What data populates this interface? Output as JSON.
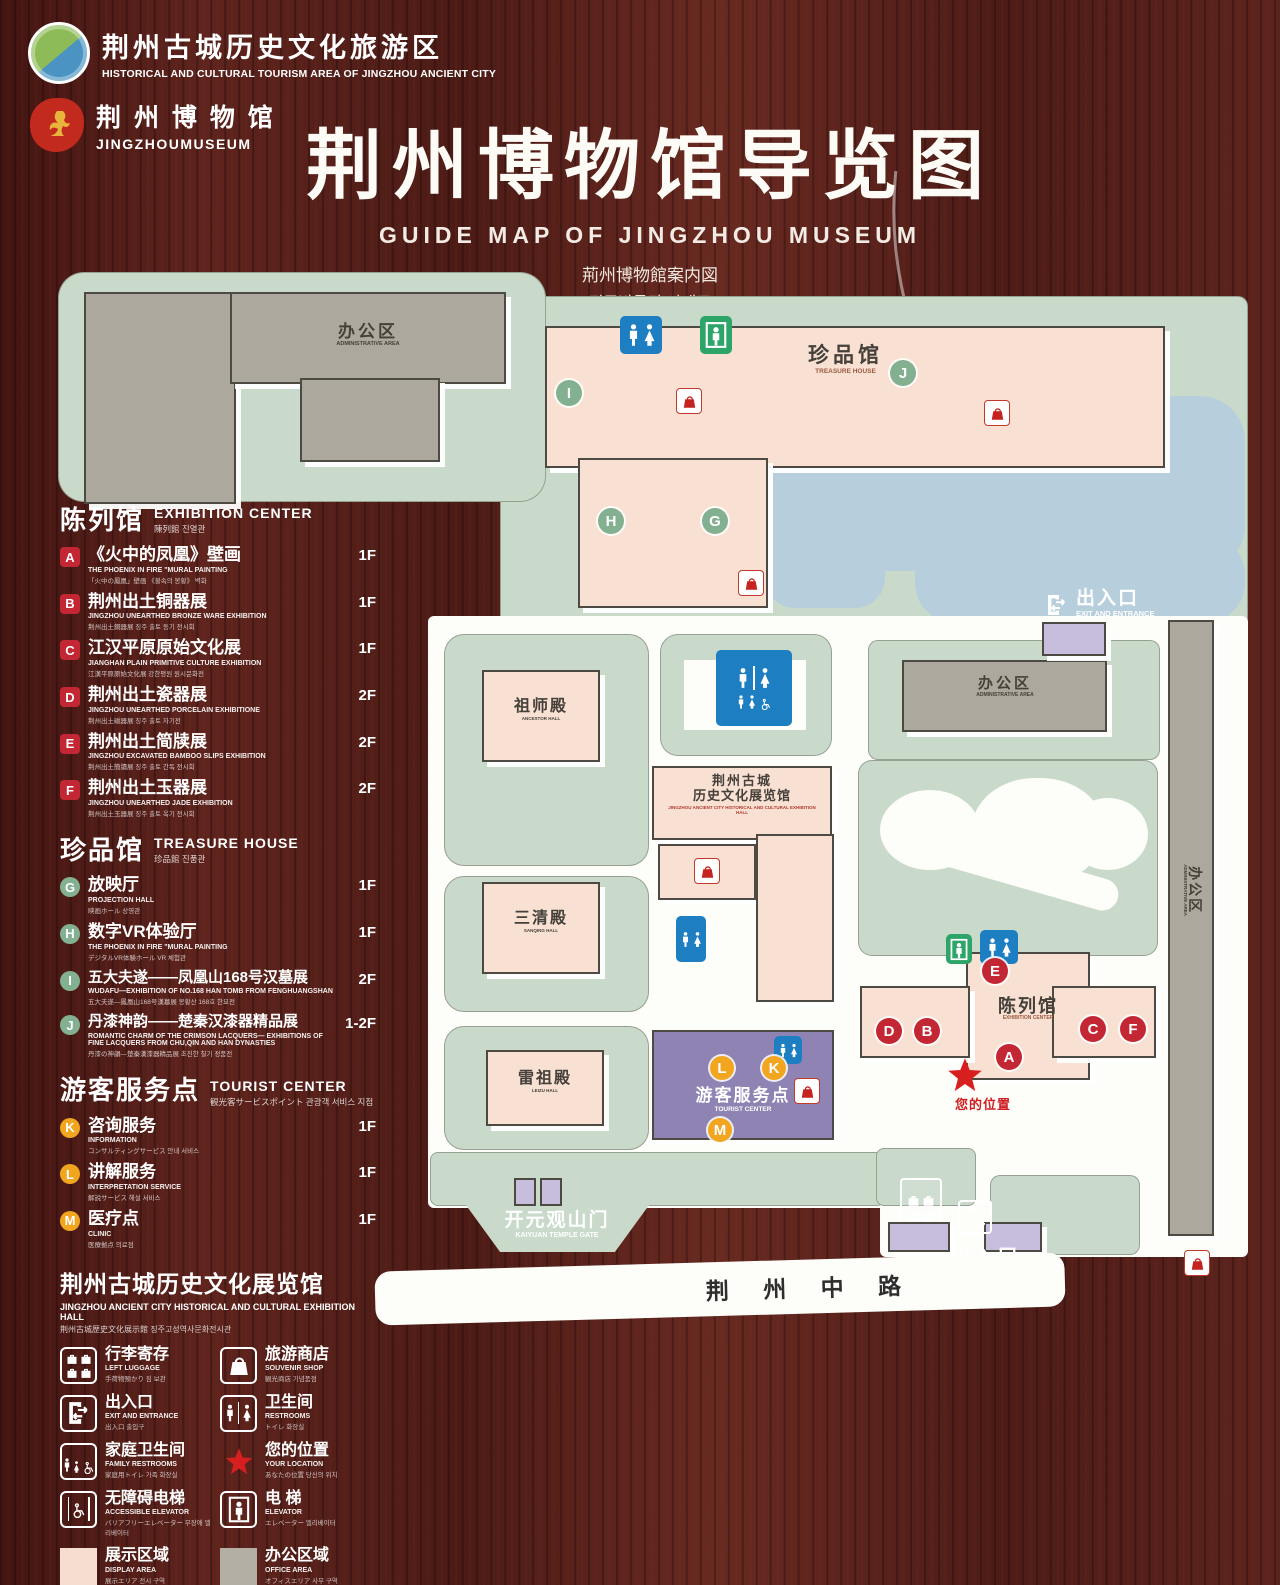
{
  "header": {
    "logo1": {
      "zh": "荆州古城历史文化旅游区",
      "en": "HISTORICAL AND CULTURAL TOURISM AREA OF JINGZHOU ANCIENT CITY"
    },
    "logo2": {
      "zh": "荆 州 博 物 馆",
      "en": "JINGZHOUMUSEUM"
    }
  },
  "title": {
    "zh": "荆州博物馆导览图",
    "en": "GUIDE MAP OF JINGZHOU MUSEUM",
    "ja": "荊州博物館案内図",
    "ko": "징주박물관 안내도"
  },
  "sections": {
    "exhibition": {
      "zh": "陈列馆",
      "en": "EXHIBITION CENTER",
      "sub": "陳列館  진열관",
      "items": [
        {
          "letter": "A",
          "zh": "《火中的凤凰》壁画",
          "en": "THE PHOENIX IN FIRE \"MURAL PAINTING",
          "sub": "「火中の鳳凰」壁画 《불속의 봉황》 벽화",
          "floor": "1F"
        },
        {
          "letter": "B",
          "zh": "荆州出土铜器展",
          "en": "JINGZHOU UNEARTHED BRONZE WARE EXHIBITION",
          "sub": "荆州出土銅器展  징주 출토 동기 전시회",
          "floor": "1F"
        },
        {
          "letter": "C",
          "zh": "江汉平原原始文化展",
          "en": "JIANGHAN PLAIN PRIMITIVE CULTURE EXHIBITION",
          "sub": "江漢平原原始文化展  강한평원 원시문화전",
          "floor": "1F"
        },
        {
          "letter": "D",
          "zh": "荆州出土瓷器展",
          "en": "JINGZHOU UNEARTHED PORCELAIN EXHIBITIONE",
          "sub": "荆州出土磁器展  징주 출토 자기전",
          "floor": "2F"
        },
        {
          "letter": "E",
          "zh": "荆州出土简牍展",
          "en": "JINGZHOU EXCAVATED BAMBOO SLIPS EXHIBITION",
          "sub": "荆州出土簡牘展  징주 출토 간독 전시회",
          "floor": "2F"
        },
        {
          "letter": "F",
          "zh": "荆州出土玉器展",
          "en": "JINGZHOU UNEARTHED JADE EXHIBITION",
          "sub": "荆州出土玉器展  징주 출토 옥기 전시회",
          "floor": "2F"
        }
      ]
    },
    "treasure": {
      "zh": "珍品馆",
      "en": "TREASURE HOUSE",
      "sub": "珍品館  진품관",
      "items": [
        {
          "letter": "G",
          "zh": "放映厅",
          "en": "PROJECTION HALL",
          "sub": "映画ホール  상영관",
          "floor": "1F"
        },
        {
          "letter": "H",
          "zh": "数字VR体验厅",
          "en": "THE PHOENIX IN FIRE \"MURAL PAINTING",
          "sub": "デジタルVR体験ホール  VR 체험관",
          "floor": "1F"
        },
        {
          "letter": "I",
          "zh": "五大夫遂——凤凰山168号汉墓展",
          "en": "WUDAFU—EXHIBITION OF NO.168 HAN TOMB FROM FENGHUANGSHAN",
          "sub": "五大夫遂—鳳凰山168号漢墓展  봉황산 168호 한묘전",
          "floor": "2F"
        },
        {
          "letter": "J",
          "zh": "丹漆神韵——楚秦汉漆器精品展",
          "en": "ROMANTIC CHARM OF THE CRIMSON LACQUERS— EXHIBITIONS OF FINE LACQUERS FROM CHU,QIN AND HAN DYNASTIES",
          "sub": "丹漆の神韻—楚秦漢漆器精品展  초진한 칠기 정품전",
          "floor": "1-2F"
        }
      ]
    },
    "tourist": {
      "zh": "游客服务点",
      "en": "TOURIST CENTER",
      "sub": "観光客サービスポイント  관광객 서비스 지점",
      "items": [
        {
          "letter": "K",
          "zh": "咨询服务",
          "en": "INFORMATION",
          "sub": "コンサルティングサービス  안내 서비스",
          "floor": "1F"
        },
        {
          "letter": "L",
          "zh": "讲解服务",
          "en": "INTERPRETATION SERVICE",
          "sub": "解説サービス  해설 서비스",
          "floor": "1F"
        },
        {
          "letter": "M",
          "zh": "医疗点",
          "en": "CLINIC",
          "sub": "医療拠点  의료점",
          "floor": "1F"
        }
      ]
    },
    "exhibition_hall": {
      "zh": "荆州古城历史文化展览馆",
      "en": "JINGZHOU ANCIENT CITY HISTORICAL AND CULTURAL EXHIBITION HALL",
      "sub": "荆州古城歴史文化展示館  징주고성역사문화전시관"
    }
  },
  "legend": {
    "items": [
      {
        "zh": "行李寄存",
        "en": "LEFT LUGGAGE",
        "sub": "手荷物預かり  짐 보관"
      },
      {
        "zh": "旅游商店",
        "en": "SOUVENIR SHOP",
        "sub": "観光商店  기념품점"
      },
      {
        "zh": "出入口",
        "en": "EXIT AND ENTRANCE",
        "sub": "出入口  출입구"
      },
      {
        "zh": "卫生间",
        "en": "RESTROOMS",
        "sub": "トイレ  화장실"
      },
      {
        "zh": "家庭卫生间",
        "en": "FAMILY RESTROOMS",
        "sub": "家庭用トイレ  가족 화장실"
      },
      {
        "zh": "您的位置",
        "en": "YOUR LOCATION",
        "sub": "あなたの位置  당신의 위치"
      },
      {
        "zh": "无障碍电梯",
        "en": "ACCESSIBLE ELEVATOR",
        "sub": "バリアフリーエレベーター  무장애 엘리베이터"
      },
      {
        "zh": "电  梯",
        "en": "ELEVATOR",
        "sub": "エレベーター  엘리베이터"
      },
      {
        "zh": "展示区域",
        "en": "DISPLAY AREA",
        "sub": "展示エリア  전시 구역"
      },
      {
        "zh": "办公区域",
        "en": "OFFICE AREA",
        "sub": "オフィスエリア  사무 구역"
      }
    ]
  },
  "map": {
    "labels": {
      "admin": {
        "zh": "办公区",
        "en": "ADMINISTRATIVE AREA"
      },
      "treasure": {
        "zh": "珍品馆",
        "en": "TREASURE HOUSE"
      },
      "ancestor": {
        "zh": "祖师殿",
        "en": "ANCESTOR HALL"
      },
      "sanqing": {
        "zh": "三清殿",
        "en": "SANQING HALL"
      },
      "leizu": {
        "zh": "雷祖殿",
        "en": "LEIZU HALL"
      },
      "exhibition_hall": {
        "zh1": "荆州古城",
        "zh2": "历史文化展览馆",
        "en": "JINGZHOU ANCIENT CITY HISTORICAL AND CULTURAL EXHIBITION HALL"
      },
      "tourist": {
        "zh": "游客服务点",
        "en": "TOURIST CENTER"
      },
      "exhibition_center": {
        "zh": "陈列馆",
        "en": "EXHIBITION CENTER"
      },
      "gate": {
        "zh": "开元观山门",
        "en": "KAIYUAN TEMPLE GATE"
      },
      "entrance": {
        "zh": "出入口",
        "en": "EXIT AND ENTRANCE"
      },
      "location": "您的位置",
      "road": "荆 州 中 路"
    }
  }
}
